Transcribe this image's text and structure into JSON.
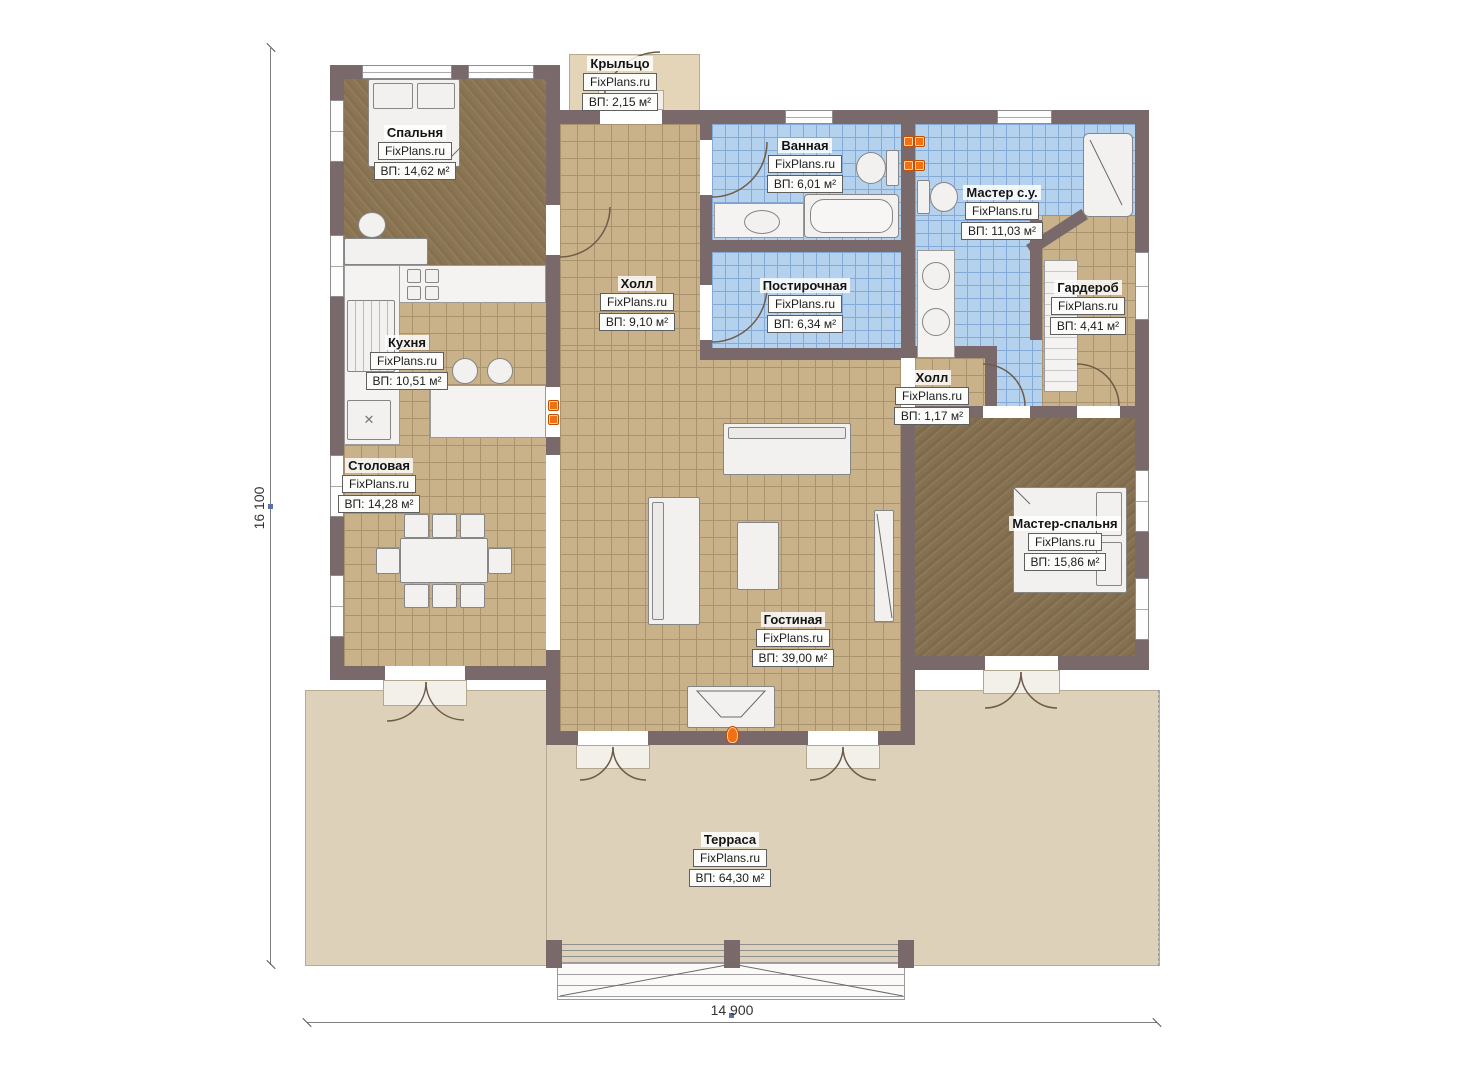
{
  "watermark": "FixPlans.ru",
  "dimensions": {
    "vertical": "16 100",
    "horizontal": "14 900"
  },
  "icons": {
    "sink_cross": "✕"
  },
  "colors": {
    "wall": "#7a696b",
    "tile_floor": "#c9b189",
    "wet_floor": "#b4d1ee",
    "wood_floor": "#8a7452",
    "terrace": "#ddd1b9",
    "radiator": "#f07014"
  },
  "rooms": [
    {
      "key": "porch",
      "name": "Крыльцо",
      "area": "ВП: 2,15 м²"
    },
    {
      "key": "bedroom",
      "name": "Спальня",
      "area": "ВП: 14,62 м²"
    },
    {
      "key": "bathroom",
      "name": "Ванная",
      "area": "ВП: 6,01 м²"
    },
    {
      "key": "master_bath",
      "name": "Мастер с.у.",
      "area": "ВП: 11,03 м²"
    },
    {
      "key": "wardrobe",
      "name": "Гардероб",
      "area": "ВП: 4,41 м²"
    },
    {
      "key": "hall",
      "name": "Холл",
      "area": "ВП: 9,10 м²"
    },
    {
      "key": "laundry",
      "name": "Постирочная",
      "area": "ВП: 6,34 м²"
    },
    {
      "key": "kitchen",
      "name": "Кухня",
      "area": "ВП: 10,51 м²"
    },
    {
      "key": "hall_small",
      "name": "Холл",
      "area": "ВП: 1,17 м²"
    },
    {
      "key": "dining",
      "name": "Столовая",
      "area": "ВП: 14,28 м²"
    },
    {
      "key": "master_bedroom",
      "name": "Мастер-спальня",
      "area": "ВП: 15,86 м²"
    },
    {
      "key": "living",
      "name": "Гостиная",
      "area": "ВП: 39,00 м²"
    },
    {
      "key": "terrace",
      "name": "Терраса",
      "area": "ВП: 64,30 м²"
    }
  ]
}
